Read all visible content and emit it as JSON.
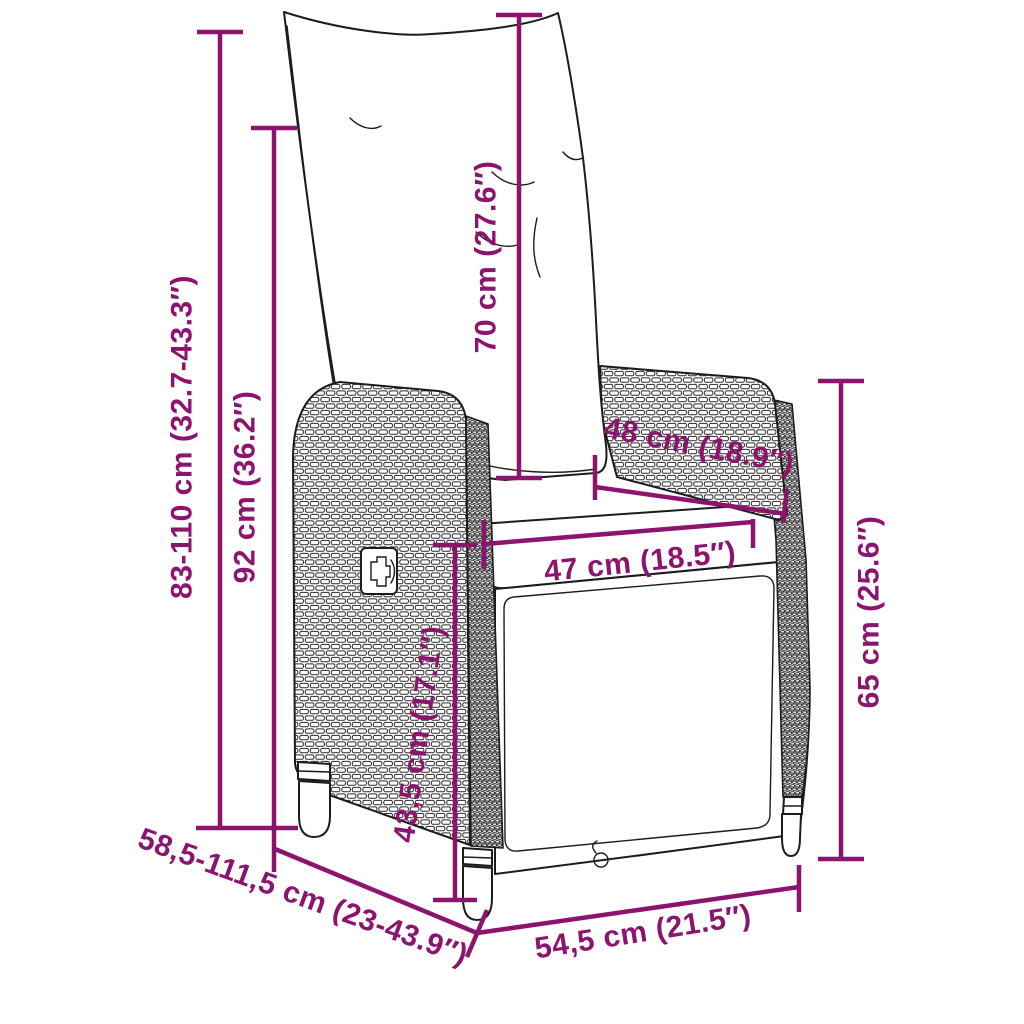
{
  "figure": {
    "background_color": "#ffffff",
    "accent_color": "#8d146e",
    "line_color": "#1c1c1c"
  },
  "dimensions": {
    "overall_height": "83-110 cm (32.7-43.3″)",
    "backrest_height": "92 cm (36.2″)",
    "back_cushion_length": "70 cm (27.6″)",
    "armrest_depth": "48 cm (18.9″)",
    "seat_width": "47 cm (18.5″)",
    "seat_height": "43,5 cm (17.1″)",
    "armrest_height": "65 cm (25.6″)",
    "overall_depth": "58,5-111,5 cm (23-43.9″)",
    "base_depth": "54,5 cm (21.5″)"
  }
}
